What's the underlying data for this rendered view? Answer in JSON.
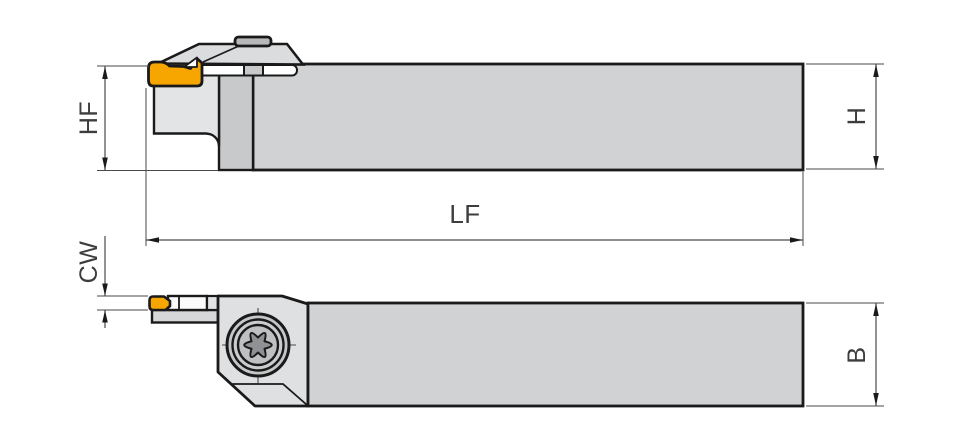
{
  "dims": {
    "hf": "HF",
    "h": "H",
    "lf": "LF",
    "cw": "CW",
    "b": "B"
  },
  "colors": {
    "insert": "#f7a600",
    "body_gray": "#d1d2d4",
    "head_gray": "#e2e3e5",
    "outline": "#1a1a1a",
    "dimension_line": "#4a4a4a"
  },
  "icons": {
    "screw": "torx-screw-icon"
  }
}
